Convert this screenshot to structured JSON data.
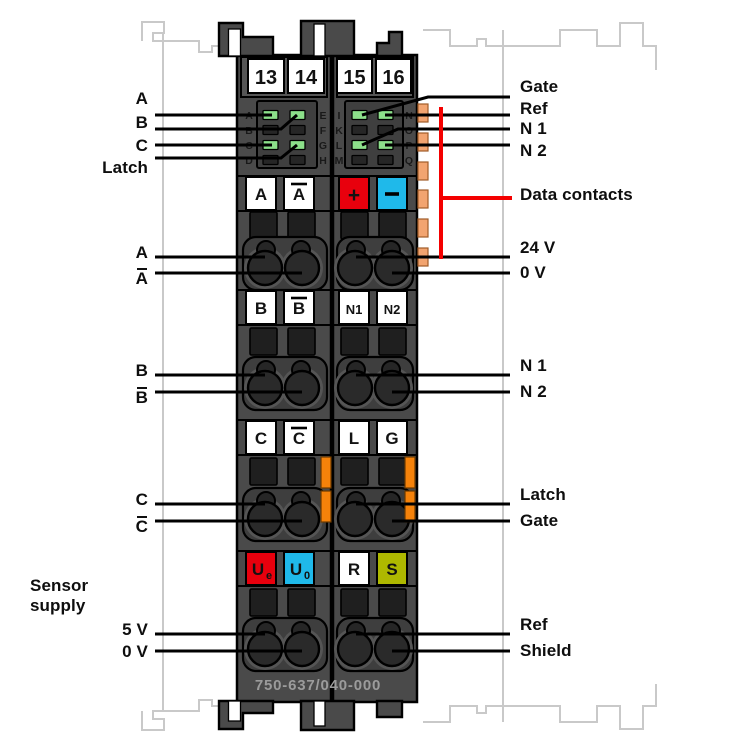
{
  "figure": {
    "model": "750-637/040-000",
    "clamp_numbers": [
      "13",
      "14",
      "15",
      "16"
    ],
    "data_contacts_label": "Data contacts",
    "sensor_supply_label": "Sensor\nsupply"
  },
  "led_blocks": [
    {
      "side": "left",
      "row_letters_left": [
        "A",
        "B",
        "C",
        "D"
      ],
      "row_letters_right": [
        "E",
        "F",
        "G",
        "H"
      ],
      "led_states": [
        [
          "on",
          "on"
        ],
        [
          "off",
          "off"
        ],
        [
          "on",
          "on"
        ],
        [
          "off",
          "off"
        ]
      ]
    },
    {
      "side": "right",
      "row_letters_left": [
        "I",
        "K",
        "L",
        "M"
      ],
      "row_letters_right": [
        "N",
        "O",
        "P",
        "Q"
      ],
      "led_states": [
        [
          "on",
          "on"
        ],
        [
          "off",
          "off"
        ],
        [
          "on",
          "on"
        ],
        [
          "off",
          "off"
        ]
      ]
    }
  ],
  "connector_boxes": {
    "rows": [
      [
        {
          "t": "A"
        },
        {
          "t": "A",
          "ov": true
        },
        {
          "t": "+",
          "bg": "red"
        },
        {
          "t": "−",
          "bg": "cyan"
        }
      ],
      [
        {
          "t": "B"
        },
        {
          "t": "B",
          "ov": true
        },
        {
          "t": "N1"
        },
        {
          "t": "N2"
        }
      ],
      [
        {
          "t": "C"
        },
        {
          "t": "C",
          "ov": true
        },
        {
          "t": "L"
        },
        {
          "t": "G"
        }
      ],
      [
        {
          "t": "U",
          "sub": "e",
          "bg": "red"
        },
        {
          "t": "U",
          "sub": "0",
          "bg": "cyan"
        },
        {
          "t": "R"
        },
        {
          "t": "S",
          "bg": "olive"
        }
      ]
    ]
  },
  "callouts": {
    "top_left": [
      "A",
      "B",
      "C",
      "Latch"
    ],
    "top_right": [
      "Gate",
      "Ref",
      "N 1",
      "N 2"
    ],
    "terminal_left": [
      [
        {
          "t": "A"
        },
        {
          "t": "A",
          "ov": true
        }
      ],
      [
        {
          "t": "B"
        },
        {
          "t": "B",
          "ov": true
        }
      ],
      [
        {
          "t": "C"
        },
        {
          "t": "C",
          "ov": true
        }
      ],
      [
        {
          "t": "5 V"
        },
        {
          "t": "0 V"
        }
      ]
    ],
    "terminal_right": [
      [
        {
          "t": "24 V"
        },
        {
          "t": "0 V"
        }
      ],
      [
        {
          "t": "N 1"
        },
        {
          "t": "N 2"
        }
      ],
      [
        {
          "t": "Latch"
        },
        {
          "t": "Gate"
        }
      ],
      [
        {
          "t": "Ref"
        },
        {
          "t": "Shield"
        }
      ]
    ]
  },
  "colors": {
    "body": "#4a4a4a",
    "band": "#565656",
    "led_frame": "#3f3f3f",
    "well": "#3e3e3e",
    "button": "#1f1f1f",
    "led_on": "#8ce08a",
    "led_off": "#262626",
    "red": "#e8000d",
    "cyan": "#1fb9ea",
    "olive": "#aeb800",
    "power_contact": "#f5820a",
    "data_contact": "#f2a470",
    "callout_red": "#f40000",
    "ghost": "#c9c9c9",
    "model_text": "#9b9b9b"
  }
}
